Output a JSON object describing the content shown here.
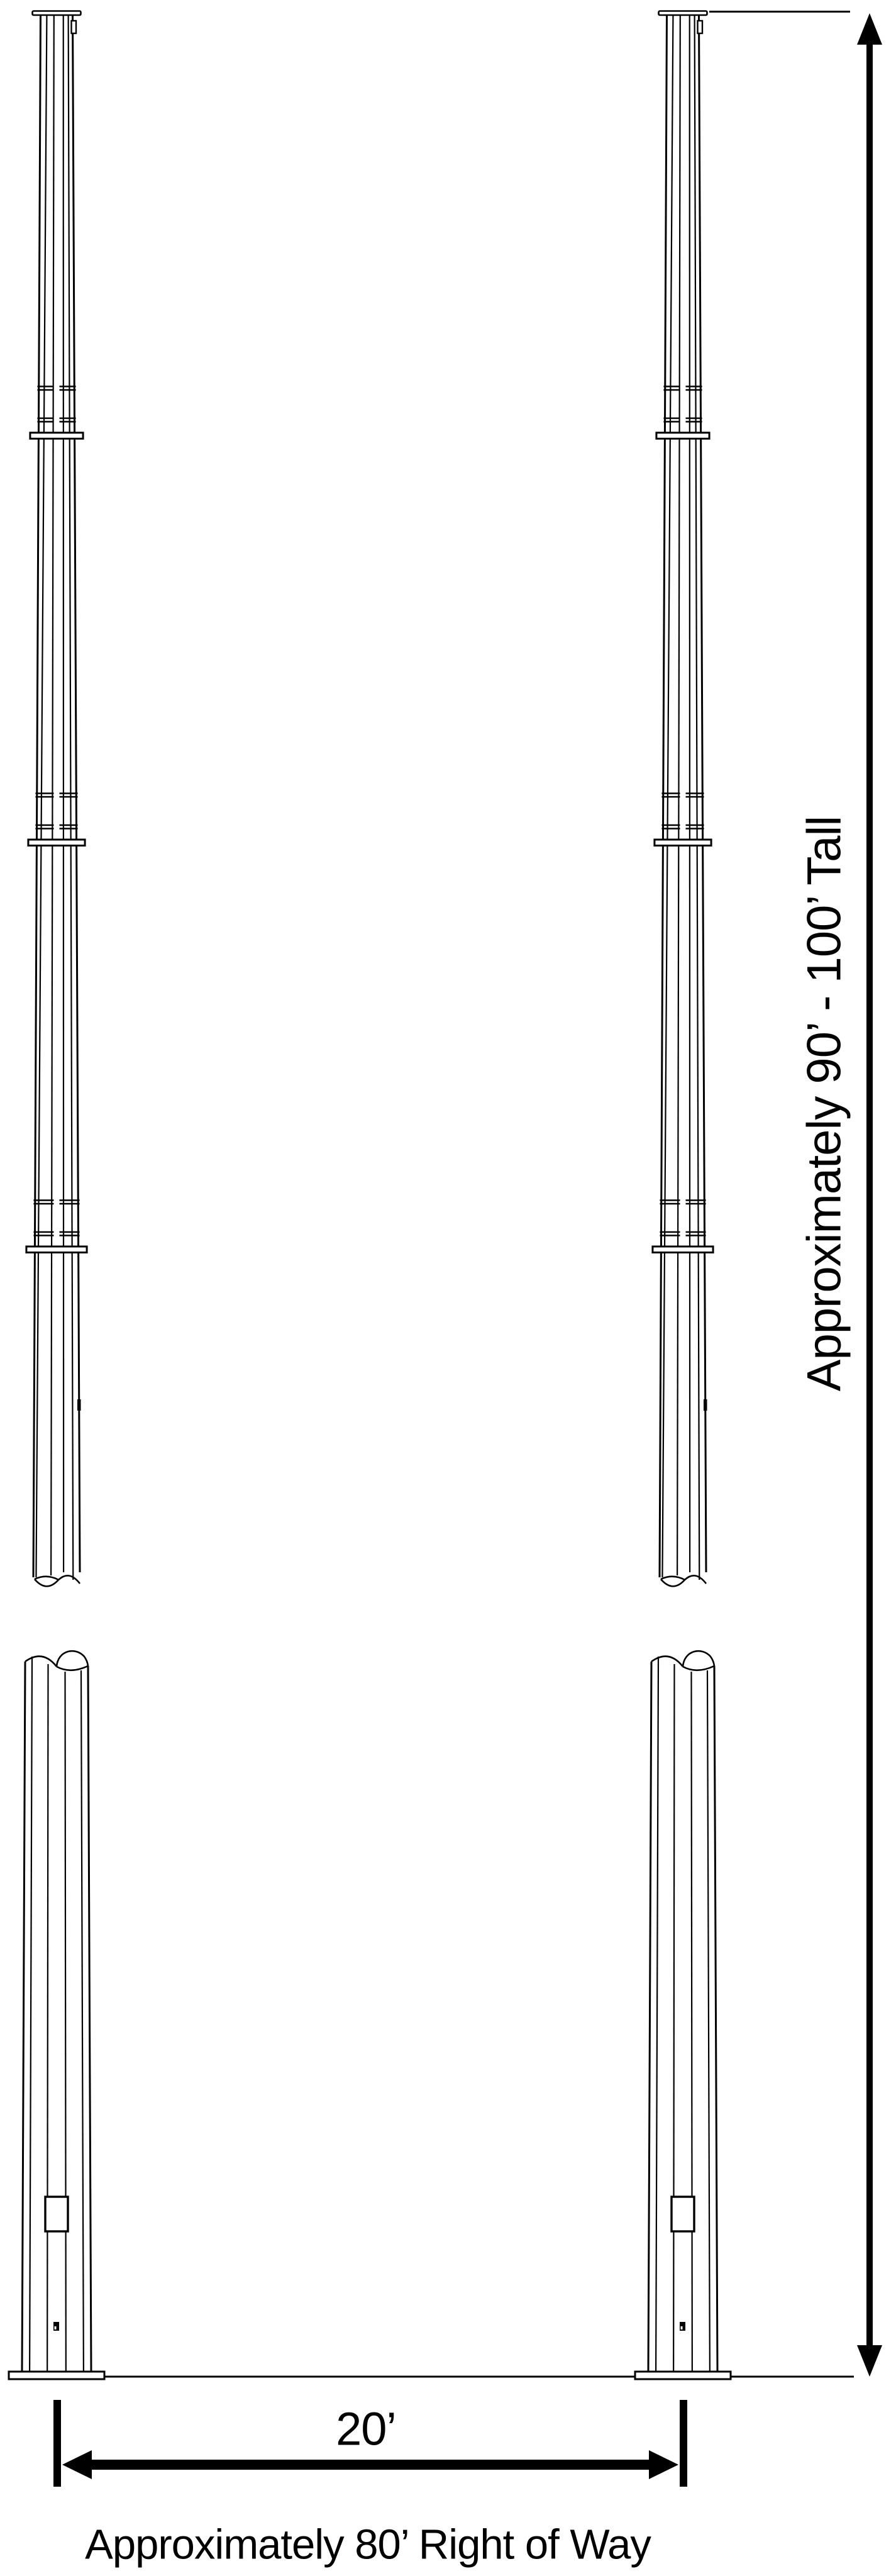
{
  "page": {
    "background": "#ffffff",
    "line_color": "#000000"
  },
  "labels": {
    "height": "Approximately 90’ - 100’ Tall",
    "pole_spacing": "20’",
    "right_of_way": "Approximately 80’ Right of Way"
  },
  "structure": {
    "pole_count": 2,
    "sections_drawn_per_pole": 2,
    "slip_joints_per_pole": 3,
    "handholes_per_pole": 1,
    "dimension_arrows": [
      "vertical-height-arrow",
      "horizontal-spacing-arrow"
    ]
  }
}
